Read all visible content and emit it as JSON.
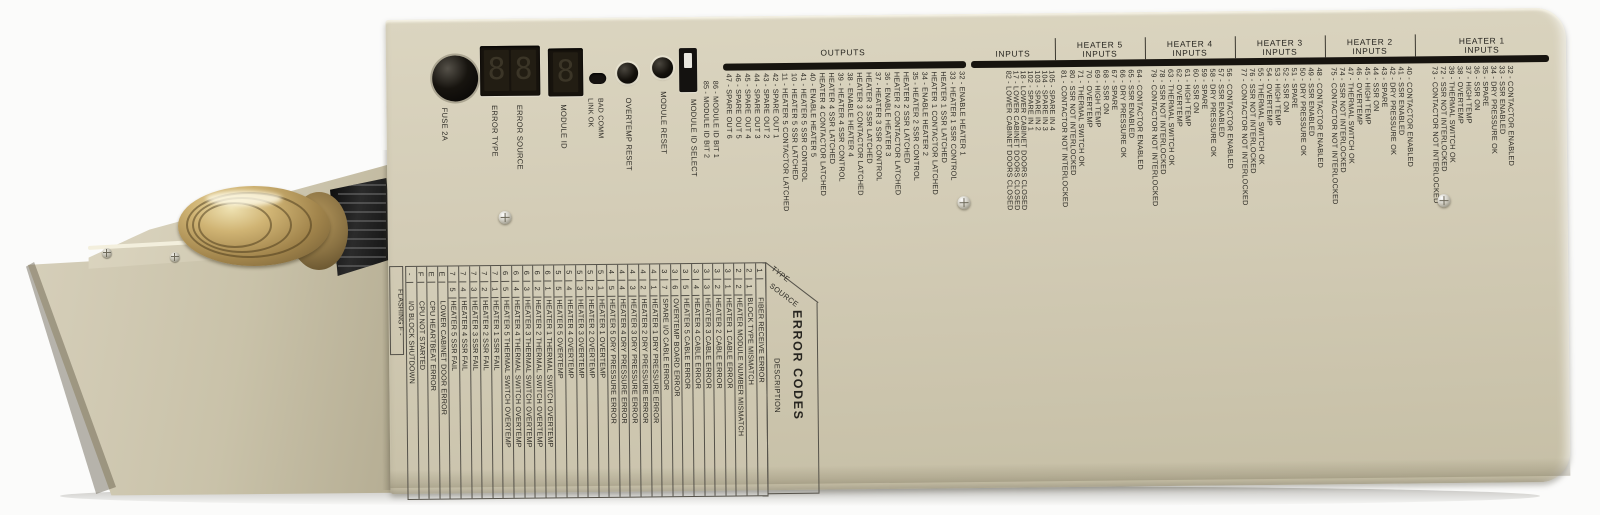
{
  "device": {
    "fuse_label": "FUSE 2A",
    "error_type_label": "ERROR TYPE",
    "error_source_label": "ERROR SOURCE",
    "module_id_label": "MODULE ID",
    "led_labels": [
      "LINK OK",
      "BAD COMM"
    ],
    "overtemp_reset_label": "OVERTEMP RESET",
    "module_reset_label": "MODULE RESET",
    "dip_label": "MODULE ID SELECT",
    "module_id_bits": [
      "85 - MODULE ID BIT 2",
      "86 - MODULE ID BIT 1"
    ],
    "display_digits": [
      "8",
      "8"
    ],
    "module_digit": "8"
  },
  "colors": {
    "panel": "#d3ccb6",
    "header_bar": "#17140f",
    "print_text": "#2d2b25",
    "brass": "#c3a868",
    "display_bezel": "#17130d"
  },
  "sections": {
    "outputs": {
      "title": "OUTPUTS",
      "lines": [
        "47 - SPARE OUT 6",
        "46 - SPARE OUT 5",
        "45 - SPARE OUT 4",
        "44 - SPARE OUT 3",
        "43 - SPARE OUT 2",
        "42 - SPARE OUT 1",
        "11 - HEATER 5 CONTACTOR LATCHED",
        "10 - HEATER 5 SSR LATCHED",
        "41 - HEATER 5 SSR CONTROL",
        "40 - ENABLE HEATER 5",
        "HEATER 4 CONTACTOR LATCHED",
        "HEATER 4 SSR LATCHED",
        "39 - HEATER 4 SSR CONTROL",
        "38 - ENABLE HEATER 4",
        "HEATER 3 CONTACTOR LATCHED",
        "HEATER 3 SSR LATCHED",
        "37 - HEATER 3 SSR CONTROL",
        "36 - ENABLE HEATER 3",
        "HEATER 2 CONTACTOR LATCHED",
        "HEATER 2 SSR LATCHED",
        "35 - HEATER 2 SSR CONTROL",
        "34 - ENABLE HEATER 2",
        "HEATER 1 CONTACTOR LATCHED",
        "HEATER 1 SSR LATCHED",
        "33 - HEATER 1 SSR CONTROL",
        "32 - ENABLE HEATER 1"
      ]
    },
    "inputs": {
      "title": "INPUTS",
      "lines": [
        "82 - LOWER CABINET DOORS CLOSED",
        "17 - LOWER CABINET DOORS CLOSED",
        "18 - LOWER CABINET DOORS CLOSED",
        "102 - SPARE IN 1",
        "103 - SPARE IN 2",
        "104 - SPARE IN 3",
        "105 - SPARE IN 4"
      ]
    },
    "heaters": [
      {
        "title": "HEATER 5",
        "subtitle": "INPUTS",
        "lines": [
          "81 - CONTACTOR NOT INTERLOCKED",
          "80 - SSR NOT INTERLOCKED",
          "71 - THERMAL SWITCH OK",
          "70 - OVERTEMP",
          "69 - HIGH TEMP",
          "68 - SSR ON",
          "67 - SPARE",
          "66 - DRY PRESSURE OK",
          "65 - SSR ENABLED",
          "64 - CONTACTOR ENABLED"
        ]
      },
      {
        "title": "HEATER 4",
        "subtitle": "INPUTS",
        "lines": [
          "79 - CONTACTOR NOT INTERLOCKED",
          "78 - SSR NOT INTERLOCKED",
          "63 - THERMAL SWITCH OK",
          "62 - OVERTEMP",
          "61 - HIGH TEMP",
          "60 - SSR ON",
          "59 - SPARE",
          "58 - DRY PRESSURE OK",
          "57 - SSR ENABLED",
          "56 - CONTACTOR ENABLED"
        ]
      },
      {
        "title": "HEATER 3",
        "subtitle": "INPUTS",
        "lines": [
          "77 - CONTACTOR NOT INTERLOCKED",
          "76 - SSR NOT INTERLOCKED",
          "55 - THERMAL SWITCH OK",
          "54 - OVERTEMP",
          "53 - HIGH TEMP",
          "52 - SSR ON",
          "51 - SPARE",
          "50 - DRY PRESSURE OK",
          "49 - SSR ENABLED",
          "48 - CONTACTOR ENABLED"
        ]
      },
      {
        "title": "HEATER 2",
        "subtitle": "INPUTS",
        "lines": [
          "75 - CONTACTOR NOT INTERLOCKED",
          "74 - SSR NOT INTERLOCKED",
          "47 - THERMAL SWITCH OK",
          "46 - OVERTEMP",
          "45 - HIGH TEMP",
          "44 - SSR ON",
          "43 - SPARE",
          "42 - DRY PRESSURE OK",
          "41 - SSR ENABLED",
          "40 - CONTACTOR ENABLED"
        ]
      },
      {
        "title": "HEATER 1",
        "subtitle": "INPUTS",
        "lines": [
          "73 - CONTACTOR NOT INTERLOCKED",
          "72 - SSR NOT INTERLOCKED",
          "39 - THERMAL SWITCH OK",
          "38 - OVERTEMP",
          "37 - HIGH TEMP",
          "36 - SSR ON",
          "35 - SPARE",
          "34 - DRY PRESSURE OK",
          "33 - SSR ENABLED",
          "32 - CONTACTOR ENABLED"
        ]
      }
    ]
  },
  "error_table": {
    "title": "ERROR CODES",
    "type_header": "TYPE",
    "source_header": "SOURCE",
    "desc_header": "DESCRIPTION",
    "flashing_note": "FLASHING F -",
    "rows": [
      {
        "type": "1",
        "source": "",
        "desc": "FIBER RECEIVE ERROR"
      },
      {
        "type": "2",
        "source": "1",
        "desc": "BLOCK TYPE MISMATCH"
      },
      {
        "type": "2",
        "source": "2",
        "desc": "HEATER MODULE NUMBER MISMATCH"
      },
      {
        "type": "3",
        "source": "1",
        "desc": "HEATER 1 CABLE ERROR"
      },
      {
        "type": "3",
        "source": "2",
        "desc": "HEATER 2 CABLE ERROR"
      },
      {
        "type": "3",
        "source": "3",
        "desc": "HEATER 3 CABLE ERROR"
      },
      {
        "type": "3",
        "source": "4",
        "desc": "HEATER 4 CABLE ERROR"
      },
      {
        "type": "3",
        "source": "5",
        "desc": "HEATER 5 CABLE ERROR"
      },
      {
        "type": "3",
        "source": "6",
        "desc": "OVERTEMP BOARD ERROR"
      },
      {
        "type": "3",
        "source": "7",
        "desc": "SPARE I/O CABLE ERROR"
      },
      {
        "type": "4",
        "source": "1",
        "desc": "HEATER 1 DRY PRESSURE ERROR"
      },
      {
        "type": "4",
        "source": "2",
        "desc": "HEATER 2 DRY PRESSURE ERROR"
      },
      {
        "type": "4",
        "source": "3",
        "desc": "HEATER 3 DRY PRESSURE ERROR"
      },
      {
        "type": "4",
        "source": "4",
        "desc": "HEATER 4 DRY PRESSURE ERROR"
      },
      {
        "type": "4",
        "source": "5",
        "desc": "HEATER 5 DRY PRESSURE ERROR"
      },
      {
        "type": "5",
        "source": "1",
        "desc": "HEATER 1 OVERTEMP"
      },
      {
        "type": "5",
        "source": "2",
        "desc": "HEATER 2 OVERTEMP"
      },
      {
        "type": "5",
        "source": "3",
        "desc": "HEATER 3 OVERTEMP"
      },
      {
        "type": "5",
        "source": "4",
        "desc": "HEATER 4 OVERTEMP"
      },
      {
        "type": "5",
        "source": "5",
        "desc": "HEATER 5 OVERTEMP"
      },
      {
        "type": "6",
        "source": "1",
        "desc": "HEATER 1 THERMAL SWITCH OVERTEMP"
      },
      {
        "type": "6",
        "source": "2",
        "desc": "HEATER 2 THERMAL SWITCH OVERTEMP"
      },
      {
        "type": "6",
        "source": "3",
        "desc": "HEATER 3 THERMAL SWITCH OVERTEMP"
      },
      {
        "type": "6",
        "source": "4",
        "desc": "HEATER 4 THERMAL SWITCH OVERTEMP"
      },
      {
        "type": "6",
        "source": "5",
        "desc": "HEATER 5 THERMAL SWITCH OVERTEMP"
      },
      {
        "type": "7",
        "source": "1",
        "desc": "HEATER 1 SSR FAIL"
      },
      {
        "type": "7",
        "source": "2",
        "desc": "HEATER 2 SSR FAIL"
      },
      {
        "type": "7",
        "source": "3",
        "desc": "HEATER 3 SSR FAIL"
      },
      {
        "type": "7",
        "source": "4",
        "desc": "HEATER 4 SSR FAIL"
      },
      {
        "type": "7",
        "source": "5",
        "desc": "HEATER 5 SSR FAIL"
      },
      {
        "type": "E",
        "source": "",
        "desc": "LOWER CABINET DOOR ERROR"
      },
      {
        "type": "E",
        "source": "",
        "desc": "CPU HEARTBEAT ERROR"
      },
      {
        "type": "F",
        "source": "",
        "desc": "CPU NOT STARTED"
      },
      {
        "type": "-",
        "source": "",
        "desc": "I/O BLOCK SHUTDOWN"
      }
    ]
  }
}
